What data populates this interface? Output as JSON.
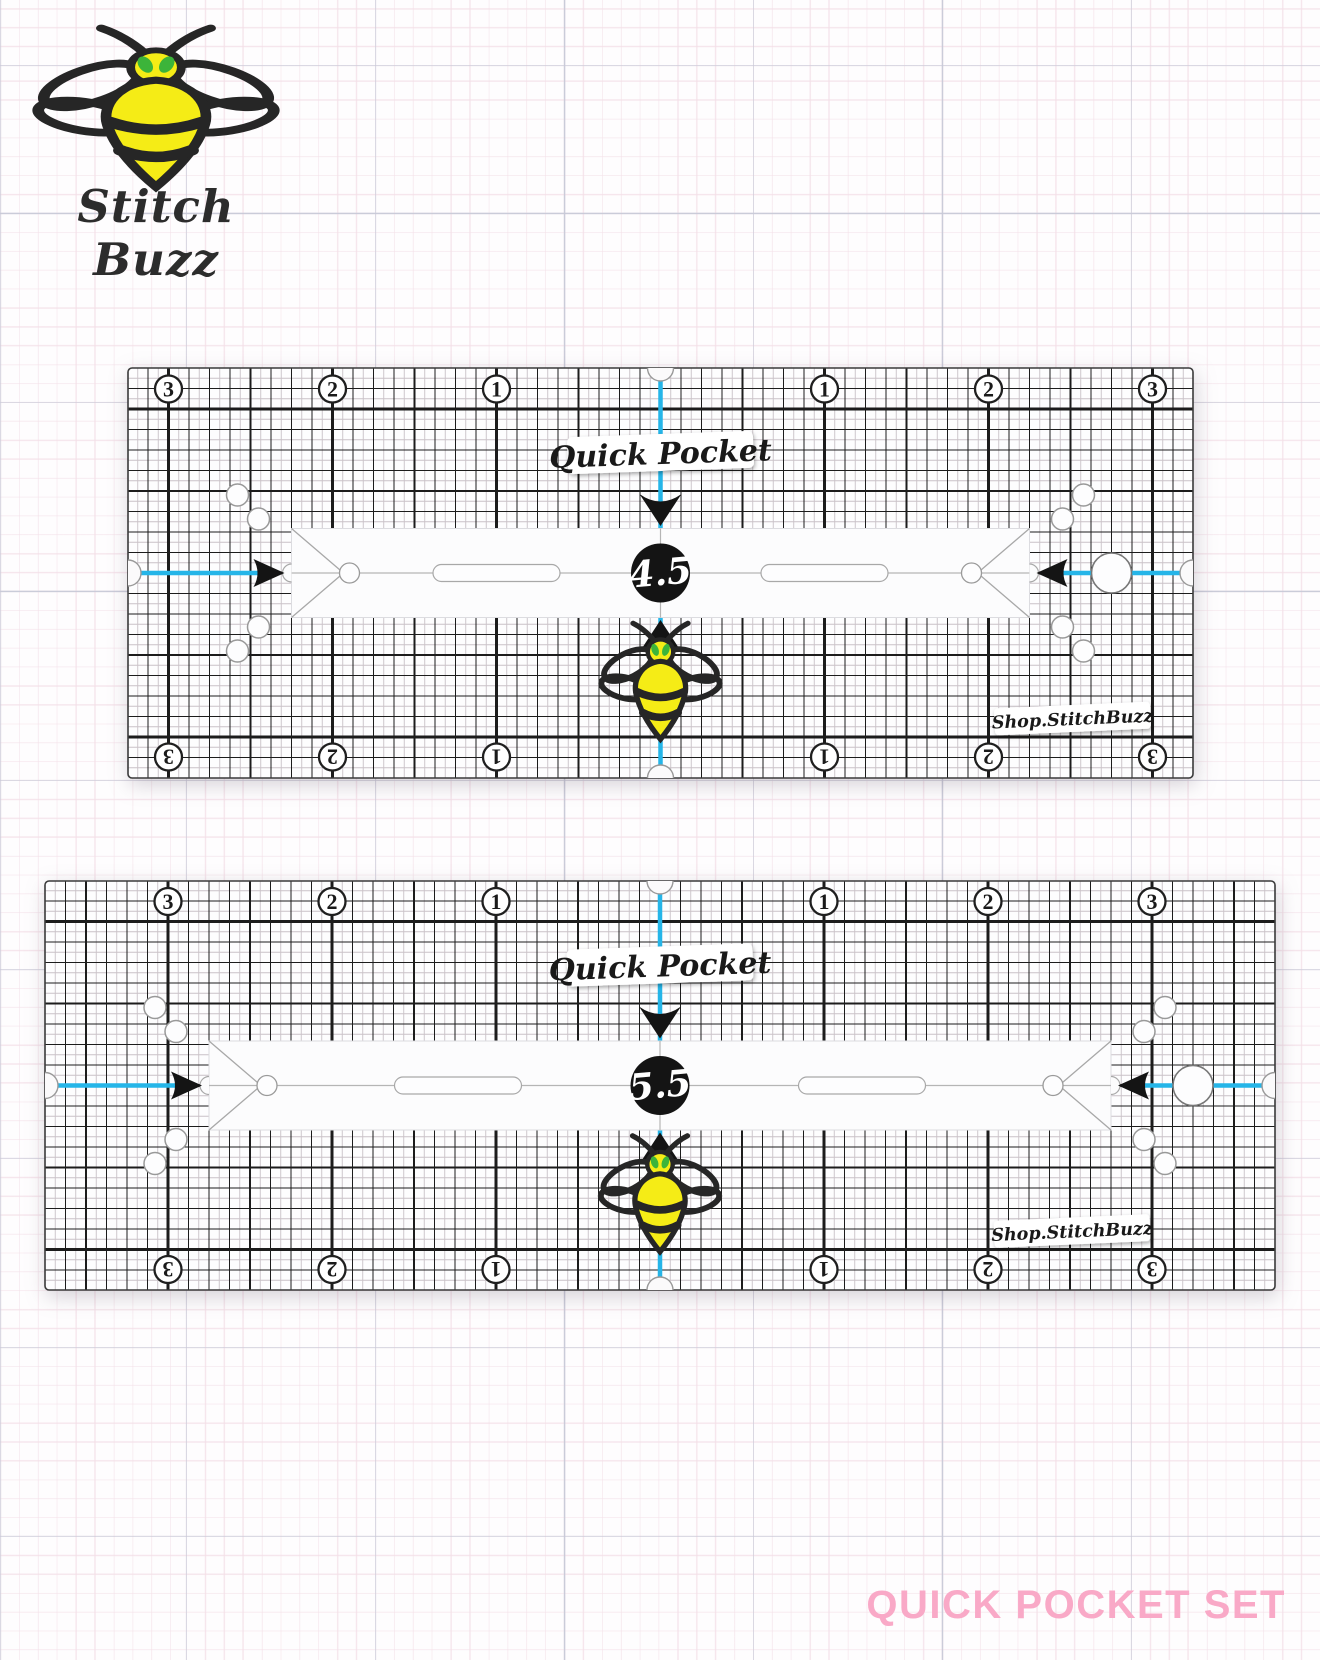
{
  "page": {
    "width": 1320,
    "height": 1660
  },
  "logo": {
    "text": "Stitch Buzz"
  },
  "title": {
    "text": "QUICK POCKET SET",
    "color": "#F9A9C7"
  },
  "colors": {
    "grid_line": "#1c1c1c",
    "grid_faint": "#c9c1c7",
    "ruler_face": "#fdfdfe",
    "cyan_guide": "#25B5E8",
    "ink_black": "#141414",
    "hole_stroke": "#999999",
    "band_stroke": "#dcdce0",
    "bee_yellow": "#F5EC16",
    "bee_green": "#3CB43A",
    "bee_outline": "#262626"
  },
  "shared": {
    "inch_px": 164,
    "fine_px": 20.5,
    "label": "Quick Pocket",
    "watermark": "Shop.StitchBuzz",
    "numbers": [
      3,
      2,
      1,
      1,
      2,
      3
    ],
    "number_offsets_in": [
      -3,
      -2,
      -1,
      1,
      2,
      3
    ]
  },
  "rulers": [
    {
      "name": "quick-pocket-ruler-4-5",
      "size_label": "4.5",
      "pocket_in": 4.5,
      "width_in": 6.5,
      "height_in": 2.5,
      "x": 128,
      "y": 368,
      "w": 1065,
      "h": 410,
      "slot_offset_px": 164
    },
    {
      "name": "quick-pocket-ruler-5-5",
      "size_label": "5.5",
      "pocket_in": 5.5,
      "width_in": 7.5,
      "height_in": 2.5,
      "x": 45,
      "y": 881,
      "w": 1230,
      "h": 409,
      "slot_offset_px": 202
    }
  ]
}
